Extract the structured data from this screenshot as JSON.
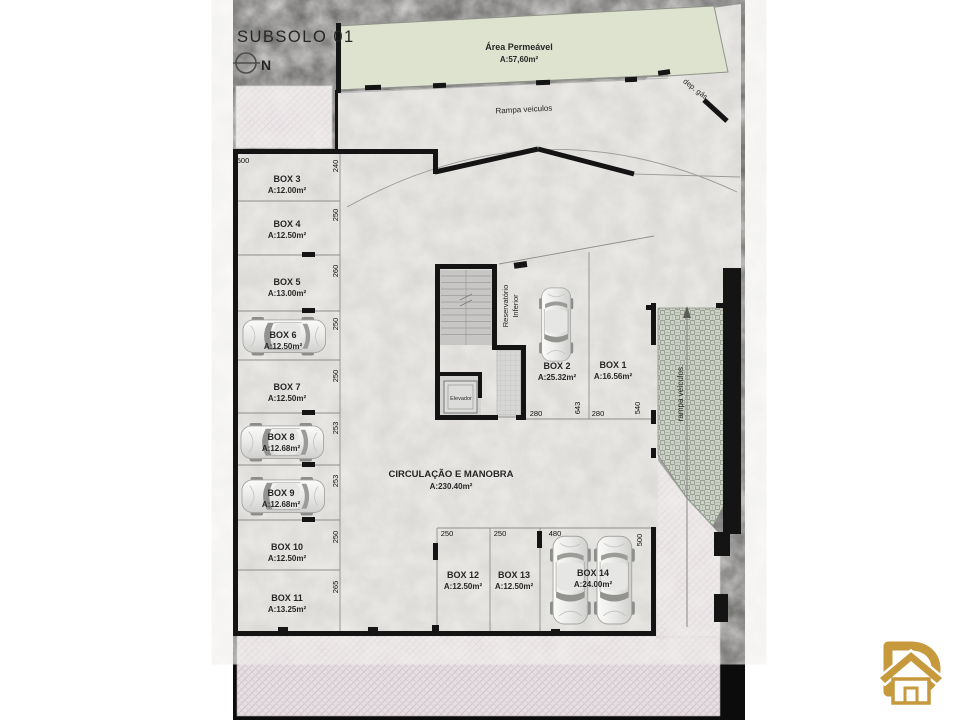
{
  "header": {
    "title": "SUBSOLO 01",
    "north_label": "N"
  },
  "labels": {
    "area_permeavel_name": "Área Permeável",
    "area_permeavel_area": "A:57,60m²",
    "rampa_top": "Rampa veiculos",
    "rampa_right": "rampa veículos.",
    "dep_gas": "dep. gás",
    "circulacao_name": "CIRCULAÇÃO E MANOBRA",
    "circulacao_area": "A:230.40m²",
    "reservatorio_line1": "Reservatório",
    "reservatorio_line2": "Inferior",
    "elevador": "Elevador"
  },
  "boxes": [
    {
      "id": "BOX 1",
      "area": "A:16.56m²"
    },
    {
      "id": "BOX 2",
      "area": "A:25.32m²"
    },
    {
      "id": "BOX 3",
      "area": "A:12.00m²"
    },
    {
      "id": "BOX 4",
      "area": "A:12.50m²"
    },
    {
      "id": "BOX 5",
      "area": "A:13.00m²"
    },
    {
      "id": "BOX 6",
      "area": "A:12.50m²"
    },
    {
      "id": "BOX 7",
      "area": "A:12.50m²"
    },
    {
      "id": "BOX 8",
      "area": "A:12.68m²"
    },
    {
      "id": "BOX 9",
      "area": "A:12.68m²"
    },
    {
      "id": "BOX 10",
      "area": "A:12.50m²"
    },
    {
      "id": "BOX 11",
      "area": "A:13.25m²"
    },
    {
      "id": "BOX 12",
      "area": "A:12.50m²"
    },
    {
      "id": "BOX 13",
      "area": "A:12.50m²"
    },
    {
      "id": "BOX 14",
      "area": "A:24.00m²"
    }
  ],
  "dimensions": {
    "left_width": "500",
    "left_heights": [
      "240",
      "250",
      "260",
      "250",
      "250",
      "253",
      "253",
      "250",
      "265"
    ],
    "core": [
      "280",
      "643",
      "280",
      "540"
    ],
    "bottom_widths": [
      "250",
      "250",
      "480"
    ],
    "bottom_height": "500"
  },
  "icons": {
    "north": "north-arrow-icon",
    "logo": "d-house-logo-icon"
  },
  "colors": {
    "wall": "#141414",
    "concrete": "#c9c8c4",
    "permeable_green": "#dde3cf",
    "sidewalk_pink": "#e7dee2",
    "ramp_hatch": "#ccd1c6",
    "brand_gold": "#c6993d"
  }
}
